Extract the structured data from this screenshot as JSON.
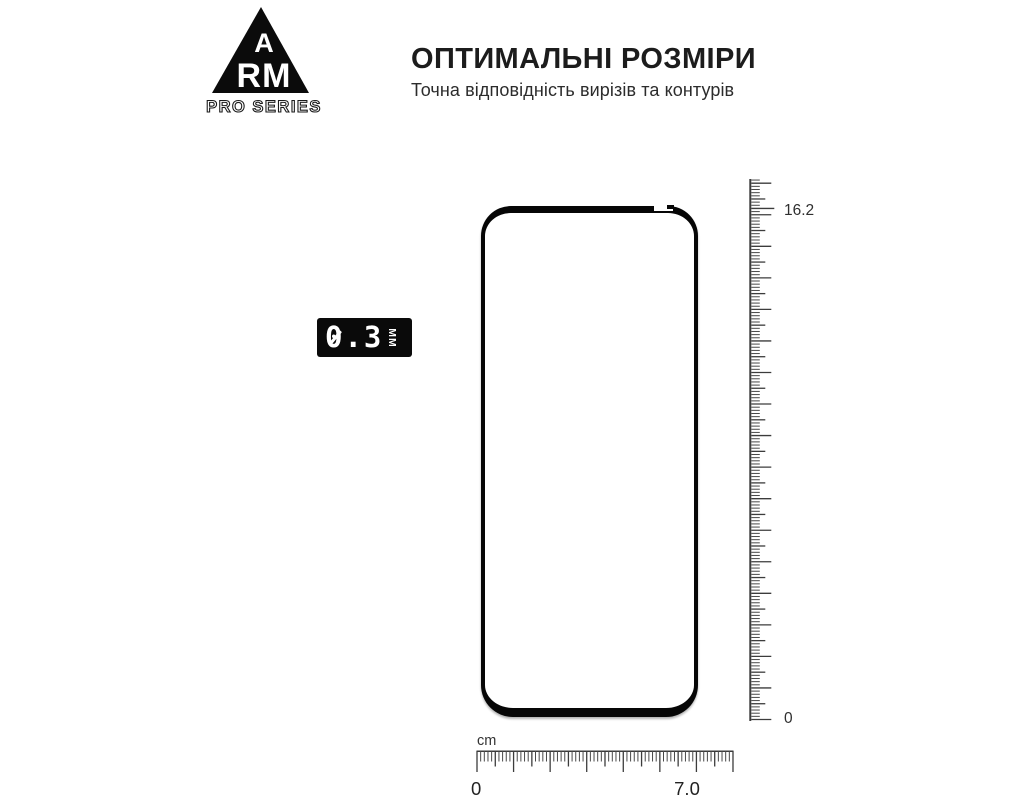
{
  "logo": {
    "letter_a": "A",
    "letters_rm": "RM",
    "series": "PRO SERIES"
  },
  "header": {
    "title": "ОПТИМАЛЬНІ РОЗМІРИ",
    "subtitle": "Точна відповідність вирізів та контурів"
  },
  "thickness_badge": {
    "value": "0.3",
    "unit": "ММ"
  },
  "vertical_ruler": {
    "top_label": "16.2",
    "bottom_label": "0"
  },
  "horizontal_ruler": {
    "unit_label": "cm",
    "left_label": "0",
    "right_label": "7.0"
  },
  "colors": {
    "ink": "#0a0a0a",
    "glass_border": "#060606",
    "tick": "#484848",
    "tick_dark": "#3c3c3c",
    "text": "#1c1c1c"
  }
}
